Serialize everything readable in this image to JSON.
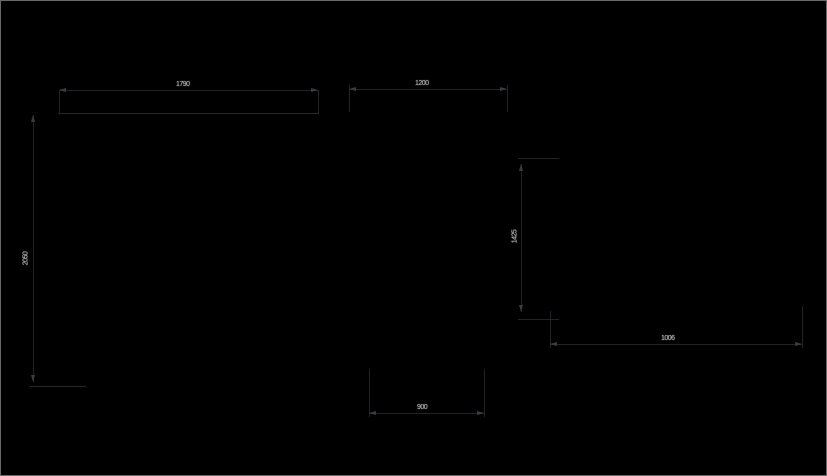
{
  "drawing": {
    "type": "cad-dimension-drawing",
    "background_color": "#000000",
    "line_color": "#232327",
    "arrow_color": "#3c3c40",
    "text_color": "#b4b4b4",
    "frame_color": "#6a6a6a",
    "dimensions": [
      {
        "id": "top-left-width",
        "value": "1790",
        "orientation": "horizontal"
      },
      {
        "id": "top-right-width",
        "value": "1200",
        "orientation": "horizontal"
      },
      {
        "id": "left-height",
        "value": "2050",
        "orientation": "vertical"
      },
      {
        "id": "right-height",
        "value": "1425",
        "orientation": "vertical"
      },
      {
        "id": "bottom-right-width",
        "value": "1006",
        "orientation": "horizontal"
      },
      {
        "id": "bottom-center-width",
        "value": "900",
        "orientation": "horizontal"
      }
    ]
  }
}
